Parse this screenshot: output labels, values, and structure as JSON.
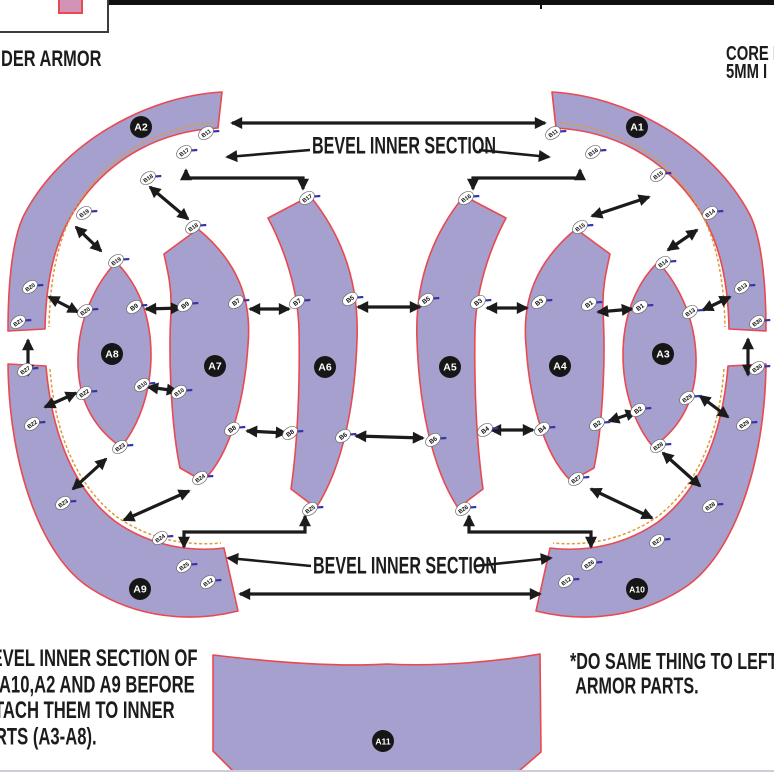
{
  "header": {
    "left_partial": "DER ARMOR",
    "right_line1": "CORE I",
    "right_line2": "5MM I"
  },
  "labels": {
    "bevel_top": "BEVEL INNER SECTION",
    "bevel_bottom": "BEVEL INNER SECTION"
  },
  "notes": {
    "left_lines": [
      "*BEVEL INNER SECTION OF",
      "A1,A10,A2 AND A9 BEFORE",
      "ATTACH THEM TO INNER",
      "PARTS (A3-A8)."
    ],
    "right_lines": [
      "*DO SAME THING TO LEFT SIDE",
      "ARMOR PARTS."
    ]
  },
  "colors": {
    "fill": "#a5a0ce",
    "edge": "#e9494f",
    "bevel": "#dd9b3e",
    "arrow": "#1b1b1b",
    "tick": "#3434ad",
    "label_bg": "#161616",
    "label_fg": "#ffffff",
    "badge_bg": "#ffffff",
    "badge_fg": "#111111",
    "pink": "#d294b6"
  },
  "pieces": [
    {
      "id": "A2",
      "label": "A2",
      "lx": 141,
      "ly": 127,
      "path": "M 222,92 C 148,96 62,142 24,215 C 13,237 8,280 8,331 L 45,329 C 46,272 58,234 78,205 C 112,156 162,131 218,128 Z"
    },
    {
      "id": "A1",
      "label": "A1",
      "lx": 637,
      "ly": 127,
      "path": "M 552,92 C 626,96 712,142 750,215 C 761,237 766,280 766,331 L 729,329 C 728,272 716,234 696,205 C 662,156 612,131 556,128 Z"
    },
    {
      "id": "A8",
      "label": "A8",
      "lx": 112,
      "ly": 354,
      "path": "M 116,262 C 94,286 79,320 78,357 C 77,396 91,426 121,447 C 139,425 151,392 151,355 C 151,317 139,285 116,262 Z"
    },
    {
      "id": "A7",
      "label": "A7",
      "lx": 215,
      "ly": 366,
      "path": "M 164,254 L 198,229 C 238,262 252,300 248,345 C 245,392 233,452 203,481 L 180,468 C 172,430 168,362 171,312 C 172,289 168,272 164,254 Z"
    },
    {
      "id": "A6",
      "label": "A6",
      "lx": 325,
      "ly": 367,
      "path": "M 268,218 L 310,196 C 346,240 359,290 357,340 C 355,400 344,465 316,508 L 291,489 C 298,440 300,380 299,330 C 298,290 285,250 268,218 Z"
    },
    {
      "id": "A5",
      "label": "A5",
      "lx": 450,
      "ly": 367,
      "path": "M 506,218 L 464,196 C 428,240 415,290 417,340 C 419,400 430,465 458,508 L 483,489 C 476,440 474,380 475,330 C 476,290 489,250 506,218 Z"
    },
    {
      "id": "A4",
      "label": "A4",
      "lx": 560,
      "ly": 366,
      "path": "M 610,254 L 576,229 C 536,262 522,300 526,345 C 529,392 541,452 571,481 L 594,468 C 602,430 606,362 603,312 C 602,289 606,272 610,254 Z"
    },
    {
      "id": "A3",
      "label": "A3",
      "lx": 663,
      "ly": 354,
      "path": "M 658,262 C 680,286 695,320 696,357 C 697,396 683,426 653,447 C 635,425 623,392 623,355 C 623,317 635,285 658,262 Z"
    },
    {
      "id": "A9",
      "label": "A9",
      "lx": 140,
      "ly": 589,
      "path": "M 8,364 L 46,366 C 52,438 76,492 116,522 C 152,547 192,552 224,548 L 238,611 C 190,623 136,618 90,588 C 42,557 9,468 8,364 Z"
    },
    {
      "id": "A10",
      "label": "A10",
      "lx": 637,
      "ly": 589,
      "path": "M 766,364 L 728,366 C 722,438 698,492 658,522 C 622,547 582,552 550,548 L 536,611 C 584,623 638,618 684,588 C 732,557 765,468 766,364 Z"
    },
    {
      "id": "A11",
      "label": "A11",
      "lx": 383,
      "ly": 741,
      "path": "M 213,655 C 280,663 340,667 387,664 C 440,667 500,661 540,654 L 541,752 L 519,771 L 233,771 L 213,751 Z"
    }
  ],
  "bevel_lines": [
    "M 214,123 C 162,127 114,151 81,199 C 61,229 50,270 49,327",
    "M 560,123 C 612,127 660,151 693,199 C 713,229 724,270 725,327",
    "M 50,369 C 55,436 78,487 117,517 C 152,541 190,546 221,543",
    "M 724,369 C 719,436 696,487 657,517 C 622,541 584,546 553,543"
  ],
  "badges": [
    {
      "l": "B11",
      "x": 206,
      "y": 133
    },
    {
      "l": "B17",
      "x": 184,
      "y": 152
    },
    {
      "l": "B18",
      "x": 148,
      "y": 178
    },
    {
      "l": "B19",
      "x": 84,
      "y": 213
    },
    {
      "l": "B20",
      "x": 30,
      "y": 287
    },
    {
      "l": "B21",
      "x": 18,
      "y": 322
    },
    {
      "l": "B11",
      "x": 553,
      "y": 133
    },
    {
      "l": "B16",
      "x": 593,
      "y": 152
    },
    {
      "l": "B15",
      "x": 658,
      "y": 175
    },
    {
      "l": "B14",
      "x": 710,
      "y": 213
    },
    {
      "l": "B13",
      "x": 742,
      "y": 287
    },
    {
      "l": "B30",
      "x": 757,
      "y": 322
    },
    {
      "l": "B27",
      "x": 25,
      "y": 370
    },
    {
      "l": "B22",
      "x": 32,
      "y": 424
    },
    {
      "l": "B23",
      "x": 63,
      "y": 503
    },
    {
      "l": "B24",
      "x": 160,
      "y": 538
    },
    {
      "l": "B25",
      "x": 184,
      "y": 566
    },
    {
      "l": "B12",
      "x": 208,
      "y": 582
    },
    {
      "l": "B30",
      "x": 757,
      "y": 368
    },
    {
      "l": "B29",
      "x": 744,
      "y": 424
    },
    {
      "l": "B28",
      "x": 710,
      "y": 506
    },
    {
      "l": "B27",
      "x": 657,
      "y": 541
    },
    {
      "l": "B26",
      "x": 589,
      "y": 564
    },
    {
      "l": "B12",
      "x": 566,
      "y": 581
    },
    {
      "l": "B19",
      "x": 116,
      "y": 261
    },
    {
      "l": "B20",
      "x": 85,
      "y": 311
    },
    {
      "l": "B9",
      "x": 134,
      "y": 307
    },
    {
      "l": "B10",
      "x": 142,
      "y": 385
    },
    {
      "l": "B22",
      "x": 84,
      "y": 393
    },
    {
      "l": "B23",
      "x": 120,
      "y": 447
    },
    {
      "l": "B18",
      "x": 193,
      "y": 227
    },
    {
      "l": "B9",
      "x": 185,
      "y": 305
    },
    {
      "l": "B7",
      "x": 236,
      "y": 302
    },
    {
      "l": "B8",
      "x": 232,
      "y": 429
    },
    {
      "l": "B10",
      "x": 179,
      "y": 392
    },
    {
      "l": "B24",
      "x": 200,
      "y": 478
    },
    {
      "l": "B17",
      "x": 307,
      "y": 198
    },
    {
      "l": "B7",
      "x": 297,
      "y": 302
    },
    {
      "l": "B5",
      "x": 350,
      "y": 299
    },
    {
      "l": "B6",
      "x": 343,
      "y": 436
    },
    {
      "l": "B8",
      "x": 290,
      "y": 433
    },
    {
      "l": "B25",
      "x": 310,
      "y": 509
    },
    {
      "l": "B16",
      "x": 466,
      "y": 198
    },
    {
      "l": "B5",
      "x": 426,
      "y": 300
    },
    {
      "l": "B3",
      "x": 478,
      "y": 302
    },
    {
      "l": "B4",
      "x": 485,
      "y": 430
    },
    {
      "l": "B6",
      "x": 433,
      "y": 440
    },
    {
      "l": "B26",
      "x": 463,
      "y": 509
    },
    {
      "l": "B15",
      "x": 580,
      "y": 227
    },
    {
      "l": "B3",
      "x": 539,
      "y": 302
    },
    {
      "l": "B1",
      "x": 589,
      "y": 304
    },
    {
      "l": "B2",
      "x": 597,
      "y": 424
    },
    {
      "l": "B4",
      "x": 542,
      "y": 429
    },
    {
      "l": "B27",
      "x": 576,
      "y": 479
    },
    {
      "l": "B14",
      "x": 663,
      "y": 263
    },
    {
      "l": "B1",
      "x": 640,
      "y": 307
    },
    {
      "l": "B13",
      "x": 690,
      "y": 312
    },
    {
      "l": "B29",
      "x": 687,
      "y": 398
    },
    {
      "l": "B2",
      "x": 638,
      "y": 410
    },
    {
      "l": "B28",
      "x": 658,
      "y": 446
    }
  ],
  "arrows": {
    "double": [
      [
        232,
        123,
        545,
        123
      ],
      [
        240,
        594,
        540,
        594
      ],
      [
        146,
        309,
        181,
        308
      ],
      [
        148,
        387,
        177,
        391
      ],
      [
        250,
        309,
        289,
        309
      ],
      [
        247,
        431,
        286,
        433
      ],
      [
        358,
        307,
        420,
        307
      ],
      [
        356,
        436,
        423,
        438
      ],
      [
        487,
        308,
        527,
        308
      ],
      [
        491,
        430,
        533,
        430
      ],
      [
        598,
        312,
        632,
        309
      ],
      [
        609,
        421,
        636,
        412
      ],
      [
        150,
        187,
        188,
        219
      ],
      [
        76,
        227,
        101,
        251
      ],
      [
        49,
        297,
        78,
        312
      ],
      [
        28,
        340,
        28,
        375
      ],
      [
        45,
        407,
        76,
        393
      ],
      [
        73,
        489,
        106,
        459
      ],
      [
        124,
        520,
        189,
        491
      ],
      [
        592,
        216,
        649,
        197
      ],
      [
        668,
        250,
        697,
        230
      ],
      [
        703,
        310,
        730,
        297
      ],
      [
        748,
        339,
        748,
        375
      ],
      [
        700,
        396,
        728,
        417
      ],
      [
        663,
        453,
        700,
        486
      ],
      [
        591,
        489,
        652,
        518
      ]
    ],
    "poly": [
      [
        186,
        170,
        186,
        178,
        303,
        178,
        303,
        189
      ],
      [
        580,
        170,
        580,
        178,
        473,
        178,
        473,
        189
      ],
      [
        184,
        547,
        184,
        532,
        305,
        532,
        305,
        516
      ],
      [
        591,
        547,
        591,
        532,
        469,
        532,
        469,
        516
      ]
    ],
    "single": [
      [
        310,
        150,
        227,
        157
      ],
      [
        479,
        150,
        549,
        157
      ],
      [
        311,
        566,
        228,
        558
      ],
      [
        475,
        566,
        551,
        558
      ]
    ]
  }
}
